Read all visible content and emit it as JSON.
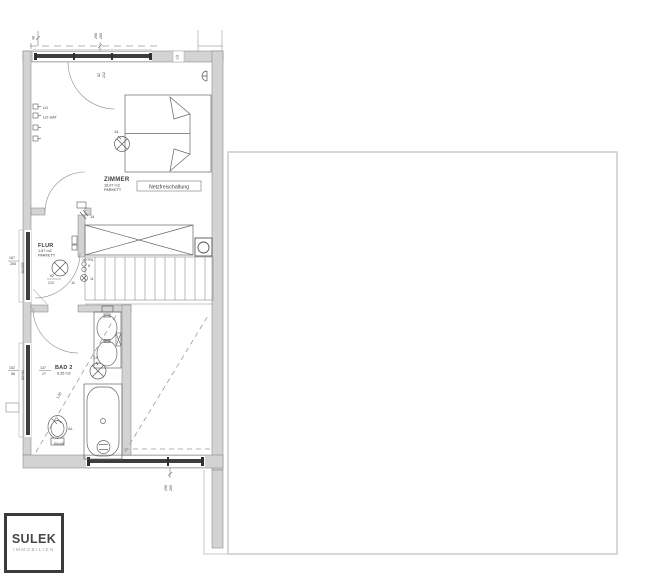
{
  "rooms": {
    "zimmer": {
      "name": "ZIMMER",
      "area": "16,97 m2",
      "floor": "PARKETT"
    },
    "flur": {
      "name": "FLUR",
      "area": "1,67 m2",
      "floor": "PARKETT"
    },
    "bad": {
      "name": "BAD 2",
      "area": "6,35 m2"
    }
  },
  "annotations": {
    "netzfreischaltung": "Netzfreischaltung"
  },
  "electrical": {
    "ld": "LD",
    "ld_sat": "LD-SAT",
    "light_zimmer": "14",
    "switch_zimmer": "14",
    "light_flur": "11",
    "flur_sub": "8",
    "flur_sub2": "11",
    "trl": "16/TRL",
    "light_bad": "13",
    "wc_outlet": "AL"
  },
  "dimensions": {
    "door_zimmer_w": "82",
    "door_zimmer_h": "212",
    "door_flur_w": "82",
    "door_flur_h": "212",
    "window_top_w": "298",
    "window_top_h": "260",
    "window_bottom_w": "298",
    "window_bottom_h": "260",
    "bad_window_w": "137",
    "bad_window_h": "27",
    "bad_left_w": "152",
    "bad_left_h": "58",
    "flur_left_w": "167",
    "flur_left_h": "265",
    "bad_window_height": "62+62",
    "flur_window_height": "80/265",
    "wc_size": "60x45",
    "headroom": "1,50",
    "vent": "LÜ",
    "corner": "40"
  },
  "logo": {
    "title": "SULEK",
    "subtitle": "IMMOBILIEN"
  },
  "colors": {
    "wall_fill": "#d3d3d3",
    "window_frame": "#3e3e3e",
    "line": "#606060",
    "terrace_border": "#c8c8c8",
    "logo_border": "#3b3b3b",
    "logo_title": "#474747",
    "logo_subtitle": "#9c9c9c"
  }
}
